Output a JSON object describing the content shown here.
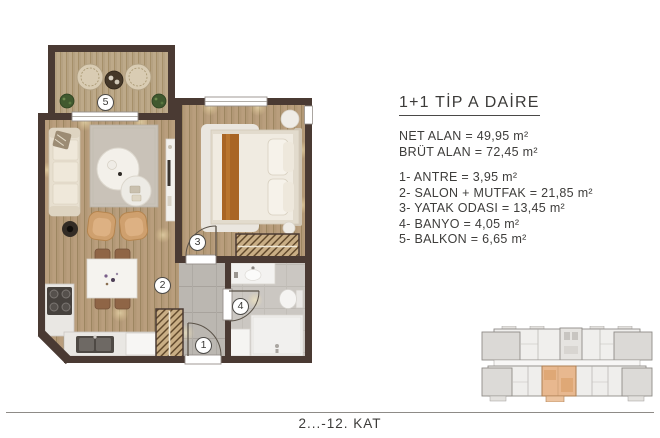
{
  "plan": {
    "badges": [
      {
        "num": "1"
      },
      {
        "num": "2"
      },
      {
        "num": "3"
      },
      {
        "num": "4"
      },
      {
        "num": "5"
      }
    ]
  },
  "info": {
    "title": "1+1 TİP A DAİRE",
    "specs": [
      {
        "line": "NET ALAN = 49,95 m²"
      },
      {
        "line": "BRÜT ALAN = 72,45 m²"
      }
    ],
    "rooms": [
      {
        "line": "1- ANTRE = 3,95 m²"
      },
      {
        "line": "2- SALON + MUTFAK = 21,85 m²"
      },
      {
        "line": "3- YATAK ODASI = 13,45 m²"
      },
      {
        "line": "4- BANYO = 4,05 m²"
      },
      {
        "line": "5- BALKON = 6,65 m²"
      }
    ]
  },
  "footer": {
    "floor_label": "2...-12. KAT"
  },
  "colors": {
    "wall": "#4a3a33",
    "wood_floor": "#b29876",
    "tile_floor": "#bbb7b1",
    "highlight_unit": "#e8b88f",
    "text": "#3e3d3b"
  }
}
